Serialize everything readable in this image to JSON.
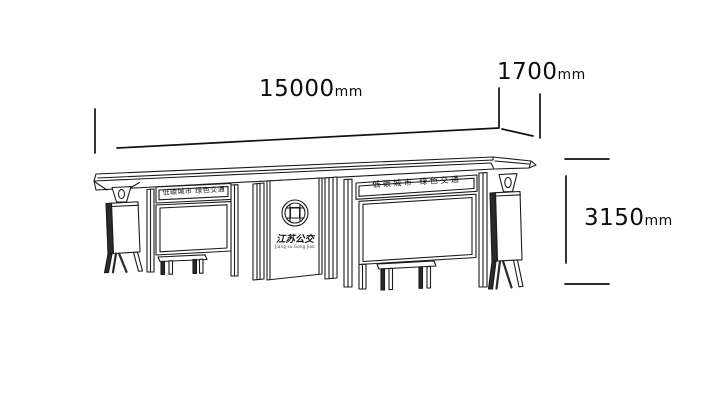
{
  "dimensions": {
    "width": {
      "value": "15000",
      "unit": "mm"
    },
    "depth": {
      "value": "1700",
      "unit": "mm"
    },
    "height": {
      "value": "3150",
      "unit": "mm"
    }
  },
  "shelter": {
    "left_header": "低碳城市 绿色交通",
    "right_header": "低碳城市 绿色交通",
    "brand_name": "江苏公交",
    "brand_pinyin": "Jiang su Gong Jiao",
    "logo_icon": "chinese-lattice-window-icon"
  },
  "colors": {
    "line": "#1b1b1b",
    "dimension_line": "#111111",
    "background": "#ffffff"
  }
}
